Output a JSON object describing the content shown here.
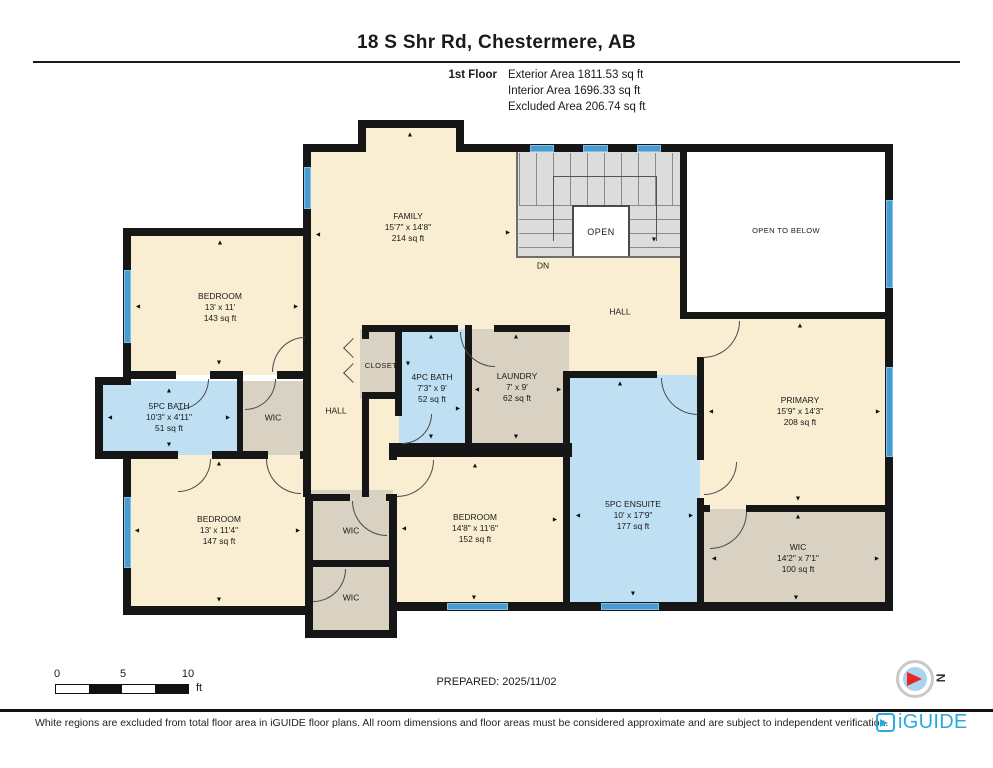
{
  "header": {
    "title": "18 S Shr Rd, Chestermere, AB",
    "floor_label": "1st Floor",
    "stats": {
      "exterior": "Exterior Area 1811.53 sq ft",
      "interior": "Interior Area 1696.33 sq ft",
      "excluded": "Excluded Area 206.74 sq ft"
    }
  },
  "rooms": {
    "family": {
      "name": "FAMILY",
      "dims": "15'7\" x 14'8\"",
      "area": "214 sq ft"
    },
    "bedroom_1": {
      "name": "BEDROOM",
      "dims": "13' x 11'",
      "area": "143 sq ft"
    },
    "bath_5pc": {
      "name": "5PC BATH",
      "dims": "10'3\" x 4'11\"",
      "area": "51 sq ft"
    },
    "wic_hall": {
      "name": "WIC"
    },
    "hall_west": {
      "name": "HALL"
    },
    "closet": {
      "name": "CLOSET"
    },
    "bath_4pc": {
      "name": "4PC BATH",
      "dims": "7'3\" x 9'",
      "area": "52 sq ft"
    },
    "laundry": {
      "name": "LAUNDRY",
      "dims": "7' x 9'",
      "area": "62 sq ft"
    },
    "hall_east": {
      "name": "HALL"
    },
    "stairs": {
      "open": "OPEN",
      "dn": "DN"
    },
    "open_to_below": {
      "name": "OPEN TO BELOW"
    },
    "bedroom_2": {
      "name": "BEDROOM",
      "dims": "13' x 11'4\"",
      "area": "147 sq ft"
    },
    "wic_1": {
      "name": "WIC"
    },
    "wic_2": {
      "name": "WIC"
    },
    "bedroom_3": {
      "name": "BEDROOM",
      "dims": "14'8\" x 11'6\"",
      "area": "152 sq ft"
    },
    "ensuite": {
      "name": "5PC ENSUITE",
      "dims": "10' x 17'9\"",
      "area": "177 sq ft"
    },
    "primary": {
      "name": "PRIMARY",
      "dims": "15'9\" x 14'3\"",
      "area": "208 sq ft"
    },
    "wic_primary": {
      "name": "WIC",
      "dims": "14'2\" x 7'1\"",
      "area": "100 sq ft"
    }
  },
  "icons": {
    "arrow_up": "▲",
    "arrow_down": "▼",
    "arrow_left": "◄",
    "arrow_right": "►"
  },
  "scale_bar": {
    "n0": "0",
    "n5": "5",
    "n10": "10",
    "unit": "ft"
  },
  "footer": {
    "prepared": "PREPARED: 2025/11/02",
    "disclaimer": "White regions are excluded from total floor area in iGUIDE floor plans. All room dimensions and floor areas must be considered approximate and are subject to independent verification.",
    "brand": "iGUIDE",
    "compass_n": "N"
  },
  "colors": {
    "wall": "#161616",
    "room_cream": "#faeed2",
    "room_blue": "#bfe0f2",
    "room_tan": "#d9d1c2",
    "stairs_grey": "#dcdcdc",
    "window_blue": "#4a9bd1",
    "brand_blue": "#29a9e0",
    "compass_red": "#e8251f"
  }
}
